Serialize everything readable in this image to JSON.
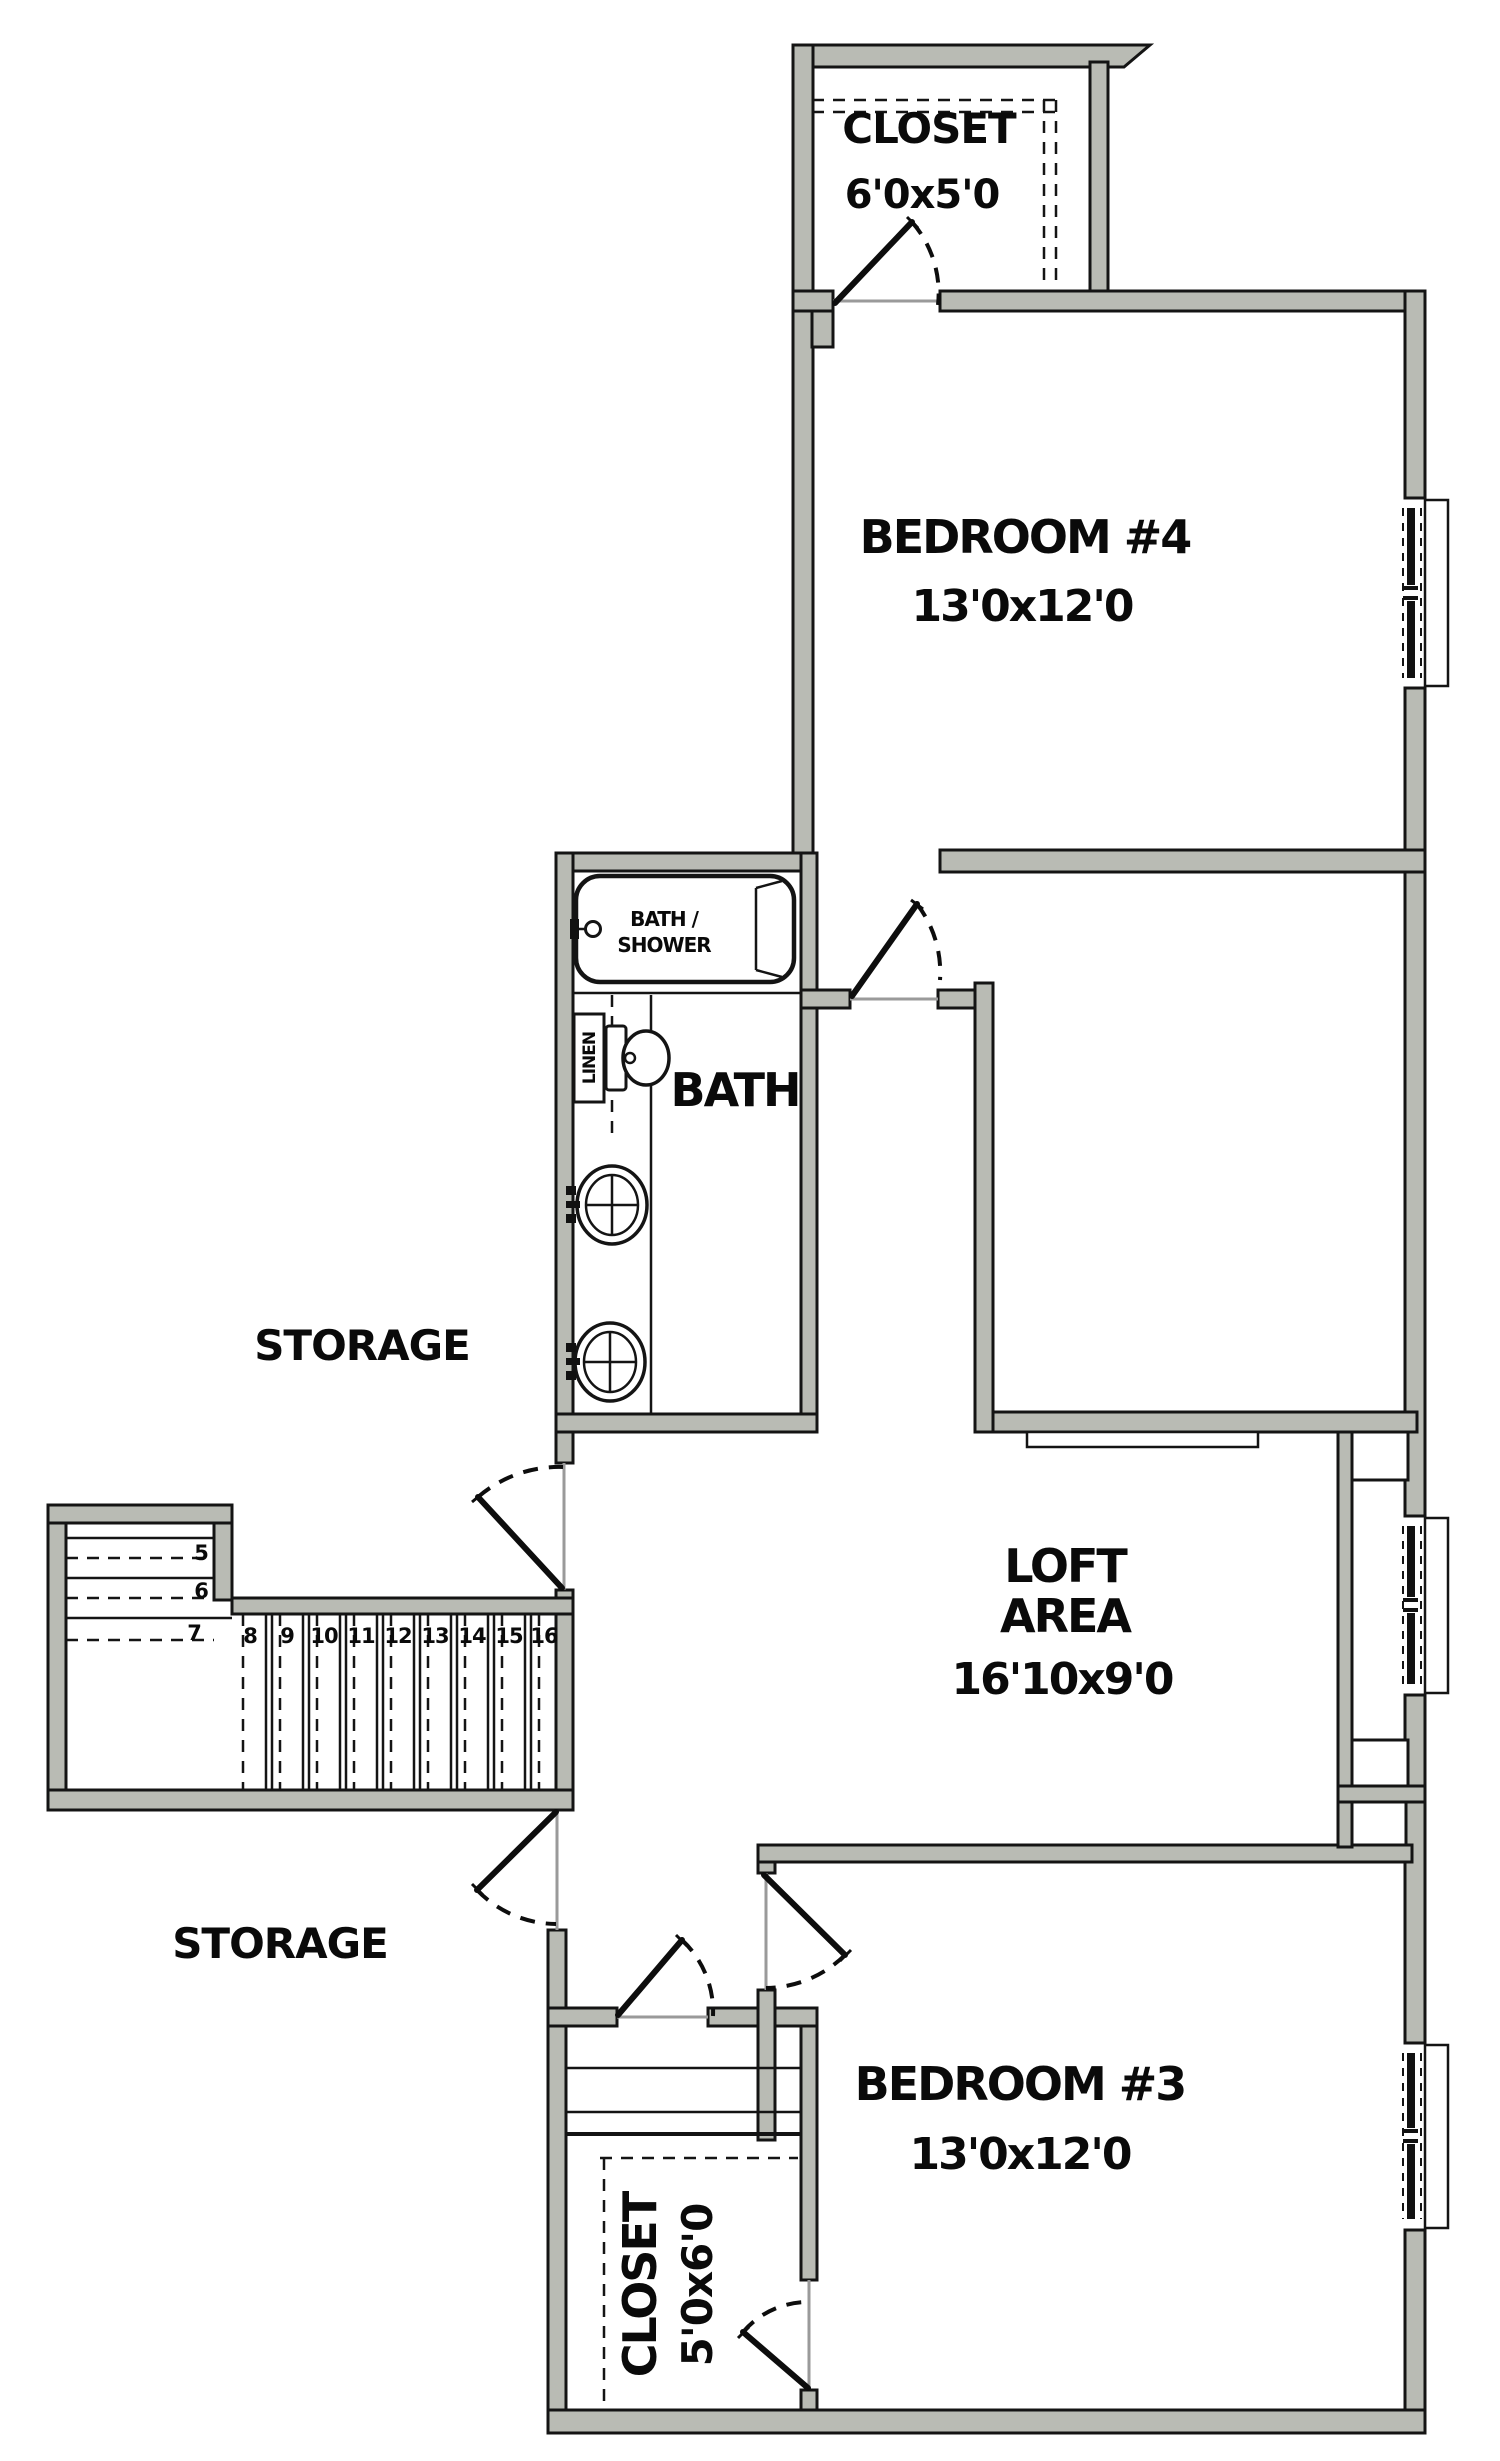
{
  "plan_title": "Second Floor Plan",
  "colors": {
    "wall_fill": "#b9bbb4",
    "line": "#141414",
    "threshold": "#9a9a9a",
    "background": "#ffffff"
  },
  "rooms": {
    "closet_top": {
      "name": "CLOSET",
      "dims": "6'0x5'0"
    },
    "bedroom4": {
      "name": "BEDROOM #4",
      "dims": "13'0x12'0"
    },
    "bath": {
      "name": "BATH"
    },
    "storage_upper": {
      "name": "STORAGE"
    },
    "loft": {
      "name_line1": "LOFT",
      "name_line2": "AREA",
      "dims": "16'10x9'0"
    },
    "storage_lower": {
      "name": "STORAGE"
    },
    "bedroom3": {
      "name": "BEDROOM #3",
      "dims": "13'0x12'0"
    },
    "closet_bottom": {
      "name": "CLOSET",
      "dims": "5'0x6'0"
    }
  },
  "fixtures": {
    "tub": {
      "label_line1": "BATH /",
      "label_line2": "SHOWER"
    },
    "linen": {
      "label": "LINEN"
    }
  },
  "stairs": {
    "numbers": [
      "5",
      "6",
      "7",
      "8",
      "9",
      "10",
      "11",
      "12",
      "13",
      "14",
      "15",
      "16"
    ]
  }
}
